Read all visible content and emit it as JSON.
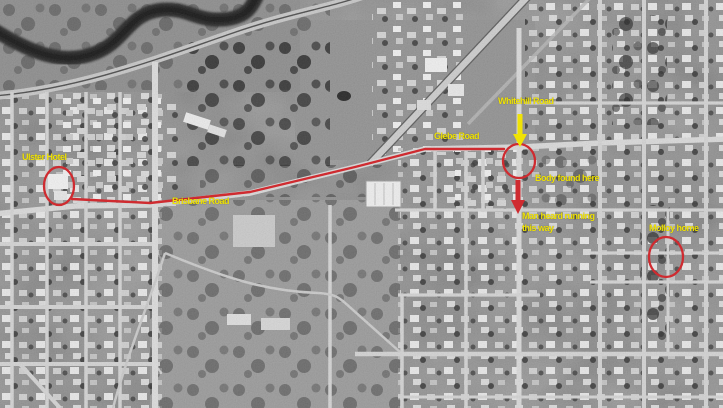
{
  "annotations": {
    "ulster_hotel": {
      "label": "Ulster Hotel"
    },
    "brisbane_road": {
      "label": "Brisbane Road"
    },
    "glebe_road": {
      "label": "Glebe Road"
    },
    "whitehill_road": {
      "label": "Whitehill Road"
    },
    "body_found": {
      "label": "Body found here"
    },
    "man_running": {
      "line1": "Man heard running",
      "line2": "this way"
    },
    "molloy_home": {
      "label": "Molloy home"
    }
  },
  "markers": {
    "route_line": {
      "points": "72,199 150,203 250,192 355,167 425,149 504,149"
    },
    "ulster_circle": {
      "cx": 59,
      "cy": 186,
      "rx": 15,
      "ry": 19
    },
    "body_circle": {
      "cx": 519,
      "cy": 161,
      "rx": 16,
      "ry": 17
    },
    "molloy_circle": {
      "cx": 666,
      "cy": 257,
      "rx": 17,
      "ry": 20
    },
    "whitehill_arrow": {
      "x": 520,
      "shaft_top": 114,
      "shaft_bottom": 135,
      "head": "513,134 527,134 520,147"
    },
    "running_arrow": {
      "x": 518,
      "shaft_top": 180,
      "shaft_bottom": 201,
      "head": "511,200 525,200 518,214"
    }
  },
  "colors": {
    "annotation-red": "#cf2b30",
    "annotation-yellow": "#f0e305"
  }
}
